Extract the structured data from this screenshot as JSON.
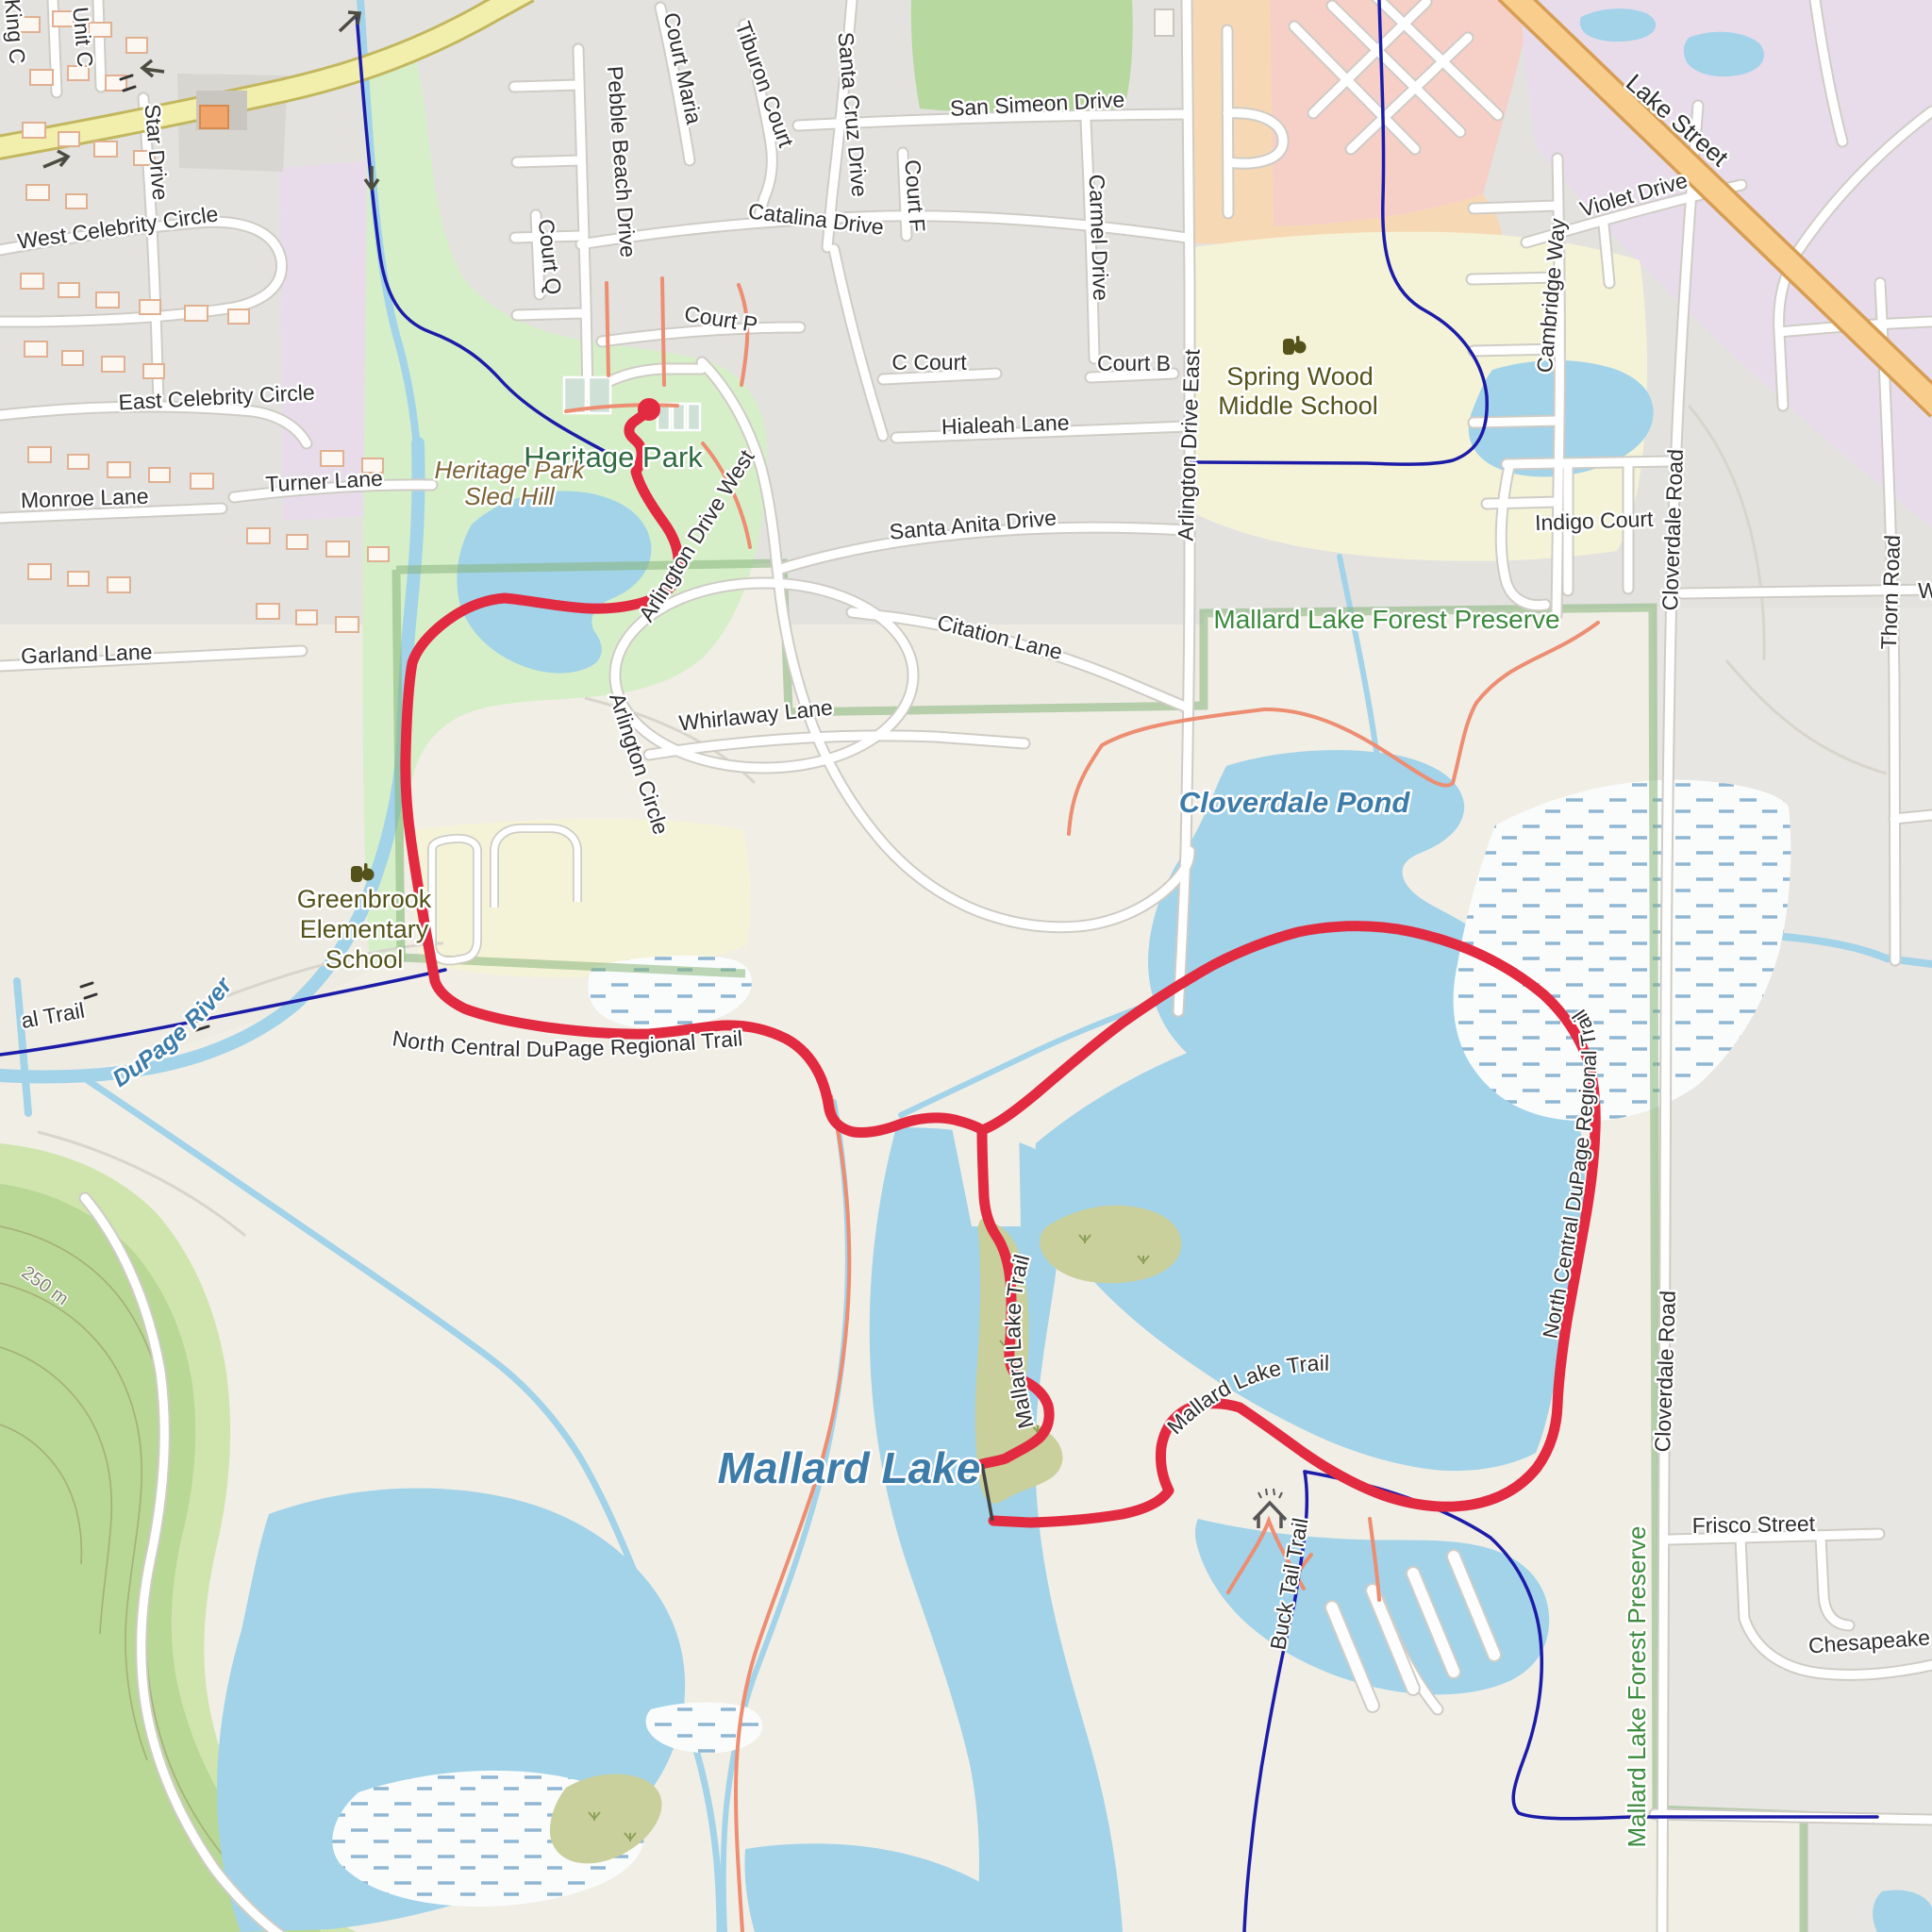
{
  "map_type": "topographic-route-map",
  "colors": {
    "water": "#a2d3e9",
    "residential": "#e3e2df",
    "preserve_land": "#f1eee6",
    "park_green": "#d7efc9",
    "hill_green": "#b9d795",
    "hill_green_light": "#cfe5ad",
    "forest_green": "#b7d89e",
    "school_yellow": "#f5f3d7",
    "retail_pink": "#f6cfc7",
    "commercial_peach": "#f6d9b4",
    "industrial_lavender": "#e8dceb",
    "road_secondary_yellow": "#f2efad",
    "road_primary_orange": "#f9cd8c",
    "route_red": "#e22b41",
    "trail_navy": "#1c1ca8",
    "path_salmon": "#ed8d72",
    "boundary_green": "#86b47a",
    "marsh_dash_blue": "#8fb6d2"
  },
  "route": {
    "color": "#e22b41",
    "start_marker": "red-dot",
    "shape": "out-and-back from Heritage Park with loop around Mallard Lake"
  },
  "labels": {
    "king_c": "King C",
    "unit_c": "Unit C",
    "star_drive": "Star Drive",
    "west_celebrity_circle": "West Celebrity Circle",
    "east_celebrity_circle": "East Celebrity Circle",
    "monroe_lane": "Monroe Lane",
    "turner_lane": "Turner Lane",
    "garland_lane": "Garland Lane",
    "pebble_beach_drive": "Pebble Beach Drive",
    "court_q": "Court Q",
    "court_maria": "Court Maria",
    "tiburon_court": "Tiburon Court",
    "santa_cruz_drive": "Santa Cruz Drive",
    "san_simeon_drive": "San Simeon Drive",
    "catalina_drive": "Catalina Drive",
    "court_f": "Court F",
    "carmel_drive": "Carmel Drive",
    "court_p": "Court P",
    "c_court": "C Court",
    "court_b": "Court B",
    "hialeah_lane": "Hialeah Lane",
    "santa_anita_drive": "Santa Anita Drive",
    "citation_lane": "Citation Lane",
    "whirlaway_lane": "Whirlaway Lane",
    "arlington_drive_west": "Arlington Drive West",
    "arlington_drive_east": "Arlington Drive East",
    "arlington_circle": "Arlington Circle",
    "cambridge_way": "Cambridge Way",
    "violet_drive": "Violet Drive",
    "lake_street": "Lake Street",
    "indigo_court": "Indigo Court",
    "cloverdale_road_north": "Cloverdale Road",
    "cloverdale_road_south": "Cloverdale Road",
    "thorn_road": "Thorn Road",
    "frisco_street": "Frisco Street",
    "chesapeake": "Chesapeake",
    "w_partial": "W",
    "heritage_park": "Heritage Park",
    "sled_hill_1": "Heritage Park",
    "sled_hill_2": "Sled Hill",
    "spring_wood_1": "Spring Wood",
    "spring_wood_2": "Middle School",
    "greenbrook_1": "Greenbrook",
    "greenbrook_2": "Elementary",
    "greenbrook_3": "School",
    "mallard_lake_forest_preserve_top": "Mallard Lake Forest Preserve",
    "mallard_lake_forest_preserve_side": "Mallard Lake Forest Preserve",
    "cloverdale_pond": "Cloverdale Pond",
    "mallard_lake": "Mallard Lake",
    "west_branch_dupage_river": "West Branch DuPage River",
    "regional_trail_clip": "al Trail",
    "nc_dupage_regional_trail_1": "North Central DuPage Regional Trail",
    "nc_dupage_regional_trail_2": "North Central DuPage Regional Trail",
    "mallard_lake_trail_1": "Mallard Lake Trail",
    "mallard_lake_trail_2": "Mallard Lake Trail",
    "buck_tail_trail": "Buck Tail Trail",
    "contour_250m": "250 m"
  }
}
